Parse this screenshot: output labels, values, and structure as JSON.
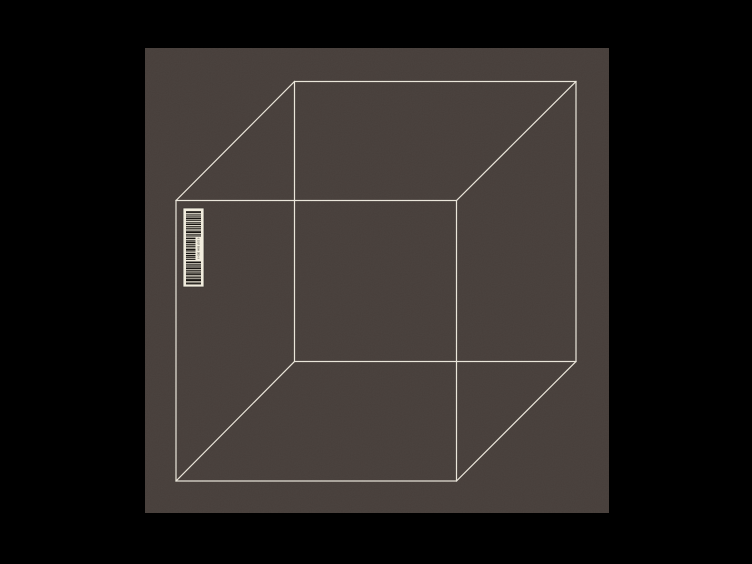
{
  "scene": {
    "description": "Minimal cover artwork: pure black field with a centered dark taupe square panel, a white wireframe cube drawn with all twelve edges, and a small rotated barcode sticker near the cube's front-top-left corner"
  },
  "colors": {
    "background": "#000000",
    "panel": "#473f3b",
    "cube_line": "#eae5d9",
    "barcode_label": "#f2eddd",
    "barcode_bar": "#16130f"
  },
  "barcode": {
    "digits": "0 1017 5000 1010 0"
  }
}
